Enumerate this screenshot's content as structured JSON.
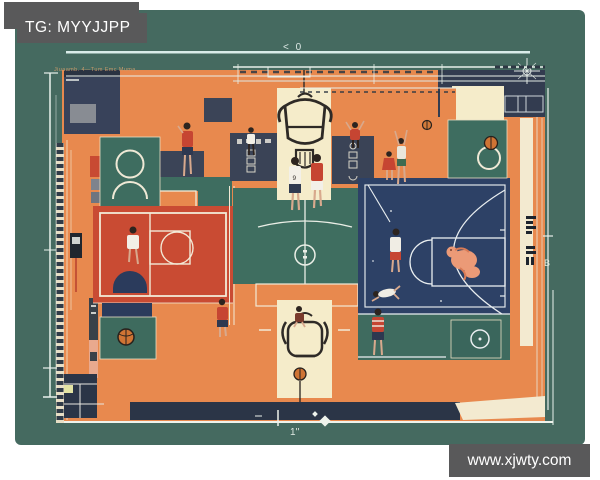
{
  "watermarks": {
    "top": "TG: MYYJJPP",
    "bottom": "www.xjwty.com"
  },
  "art": {
    "subject": "top-down stylized basketball court illustration with players",
    "annotation": "Jiuaamb. 4—Tum  Emc  Muma",
    "markers": {
      "top": "< 0",
      "right": "B",
      "bottom": "1''"
    },
    "jersey_number": "9",
    "palette": {
      "background_teal": "#456a60",
      "court_orange": "#e8894e",
      "court_red": "#c94b33",
      "court_navy": "#2d4166",
      "panel_slate": "#3a4255",
      "band_navy": "#2b3547",
      "cream": "#f6edca",
      "line_white": "#f2ead6",
      "accent_salmon": "#eb9a77",
      "watermark_gray": "#59595a"
    }
  }
}
